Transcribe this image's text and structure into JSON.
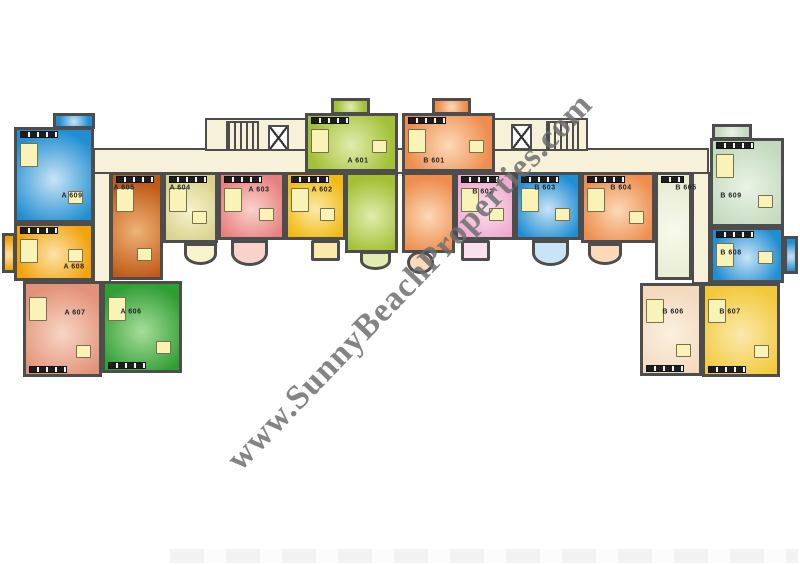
{
  "watermark": {
    "text": "www.SunnyBeachProperties.com",
    "color": "#6f6f6f",
    "rotation_deg": -46
  },
  "floorplan": {
    "wall_color": "#4d4d4d",
    "corridor_color": "#f6f1d8",
    "furniture_fill": "#faf3b8",
    "fixture_color": "#1d1d1d",
    "corridors": [
      {
        "name": "main-hall",
        "x": 93,
        "y": 148,
        "w": 616,
        "h": 26
      },
      {
        "name": "stair-lobby-left",
        "x": 205,
        "y": 118,
        "w": 102,
        "h": 33
      },
      {
        "name": "stair-lobby-right",
        "x": 493,
        "y": 118,
        "w": 95,
        "h": 33
      },
      {
        "name": "left-vertical-hall",
        "x": 93,
        "y": 172,
        "w": 18,
        "h": 145
      },
      {
        "name": "right-vertical-hall",
        "x": 692,
        "y": 172,
        "w": 18,
        "h": 112
      }
    ],
    "stairs": [
      {
        "side": "left",
        "x": 226,
        "y": 121,
        "w": 33,
        "h": 30
      },
      {
        "side": "right",
        "x": 546,
        "y": 121,
        "w": 33,
        "h": 30
      }
    ],
    "elevators": [
      {
        "side": "left",
        "x": 268,
        "y": 125,
        "w": 21,
        "h": 26
      },
      {
        "side": "right",
        "x": 511,
        "y": 124,
        "w": 21,
        "h": 26
      }
    ],
    "units": [
      {
        "id": "A609",
        "label": "A 609",
        "color": "#1f8ed2",
        "light": "#c9e4f5",
        "rects": [
          {
            "x": 14,
            "y": 127,
            "w": 80,
            "h": 96
          },
          {
            "x": 53,
            "y": 113,
            "w": 42,
            "h": 16
          }
        ],
        "label_pos": {
          "x": 72,
          "y": 196
        },
        "fixture": "top"
      },
      {
        "id": "A608",
        "label": "A 608",
        "color": "#f2a30c",
        "light": "#fce3a8",
        "rects": [
          {
            "x": 14,
            "y": 223,
            "w": 80,
            "h": 58
          },
          {
            "x": 2,
            "y": 233,
            "w": 14,
            "h": 40
          }
        ],
        "label_pos": {
          "x": 74,
          "y": 267
        },
        "fixture": "top"
      },
      {
        "id": "A607",
        "label": "A 607",
        "color": "#e39178",
        "light": "#f7d6c5",
        "rects": [
          {
            "x": 23,
            "y": 281,
            "w": 79,
            "h": 96
          }
        ],
        "label_pos": {
          "x": 75,
          "y": 313
        },
        "fixture": "bottom"
      },
      {
        "id": "A606",
        "label": "A 606",
        "color": "#2f9e33",
        "light": "#a8dd9a",
        "rects": [
          {
            "x": 102,
            "y": 281,
            "w": 80,
            "h": 92
          }
        ],
        "label_pos": {
          "x": 131,
          "y": 312
        },
        "fixture": "bottom"
      },
      {
        "id": "A605",
        "label": "A 605",
        "color": "#c05a17",
        "light": "#efb377",
        "rects": [
          {
            "x": 110,
            "y": 172,
            "w": 53,
            "h": 108
          }
        ],
        "label_pos": {
          "x": 124,
          "y": 188
        },
        "fixture": "top"
      },
      {
        "id": "A604",
        "label": "A 604",
        "color": "#d8d28b",
        "light": "#f7f3cd",
        "rects": [
          {
            "x": 163,
            "y": 172,
            "w": 55,
            "h": 71
          }
        ],
        "balcony": {
          "x": 184,
          "y": 243,
          "w": 33,
          "h": 22,
          "shape": "semi"
        },
        "label_pos": {
          "x": 180,
          "y": 188
        },
        "fixture": "top"
      },
      {
        "id": "A603",
        "label": "A 603",
        "color": "#e88080",
        "light": "#f9d3cb",
        "rects": [
          {
            "x": 218,
            "y": 172,
            "w": 67,
            "h": 68
          }
        ],
        "balcony": {
          "x": 231,
          "y": 240,
          "w": 37,
          "h": 26,
          "shape": "semi"
        },
        "label_pos": {
          "x": 259,
          "y": 190
        },
        "fixture": "top"
      },
      {
        "id": "A602",
        "label": "A 602",
        "color": "#f1ba10",
        "light": "#fbe9a8",
        "rects": [
          {
            "x": 285,
            "y": 172,
            "w": 61,
            "h": 68
          }
        ],
        "balcony": {
          "x": 311,
          "y": 240,
          "w": 29,
          "h": 21,
          "shape": "rect"
        },
        "label_pos": {
          "x": 322,
          "y": 190
        },
        "fixture": "top"
      },
      {
        "id": "A601",
        "label": "A 601",
        "color": "#a3c135",
        "light": "#e1ecae",
        "rects": [
          {
            "x": 305,
            "y": 113,
            "w": 93,
            "h": 59
          },
          {
            "x": 345,
            "y": 172,
            "w": 53,
            "h": 81
          },
          {
            "x": 331,
            "y": 98,
            "w": 39,
            "h": 17
          }
        ],
        "balcony": {
          "x": 360,
          "y": 251,
          "w": 31,
          "h": 19,
          "shape": "semi"
        },
        "label_pos": {
          "x": 358,
          "y": 161
        },
        "fixture": "top"
      },
      {
        "id": "B601",
        "label": "B 601",
        "color": "#ee8e4e",
        "light": "#fbd9b9",
        "rects": [
          {
            "x": 402,
            "y": 113,
            "w": 93,
            "h": 59
          },
          {
            "x": 402,
            "y": 172,
            "w": 53,
            "h": 81
          },
          {
            "x": 432,
            "y": 98,
            "w": 39,
            "h": 17
          }
        ],
        "balcony": {
          "x": 407,
          "y": 251,
          "w": 27,
          "h": 23,
          "shape": "circle"
        },
        "label_pos": {
          "x": 434,
          "y": 161
        },
        "fixture": "top"
      },
      {
        "id": "B602",
        "label": "B 602",
        "color": "#eeaacd",
        "light": "#fadfee",
        "rects": [
          {
            "x": 455,
            "y": 172,
            "w": 60,
            "h": 68
          }
        ],
        "balcony": {
          "x": 461,
          "y": 240,
          "w": 29,
          "h": 21,
          "shape": "rect"
        },
        "label_pos": {
          "x": 483,
          "y": 192
        },
        "fixture": "top"
      },
      {
        "id": "B603",
        "label": "B 603",
        "color": "#1f8ed2",
        "light": "#c9e4f5",
        "rects": [
          {
            "x": 515,
            "y": 172,
            "w": 66,
            "h": 68
          }
        ],
        "balcony": {
          "x": 532,
          "y": 240,
          "w": 37,
          "h": 26,
          "shape": "semi"
        },
        "label_pos": {
          "x": 545,
          "y": 188
        },
        "fixture": "top"
      },
      {
        "id": "B604",
        "label": "B 604",
        "color": "#ee8e4e",
        "light": "#fbd9b9",
        "rects": [
          {
            "x": 581,
            "y": 172,
            "w": 74,
            "h": 71
          }
        ],
        "balcony": {
          "x": 588,
          "y": 243,
          "w": 34,
          "h": 22,
          "shape": "semi"
        },
        "label_pos": {
          "x": 621,
          "y": 188
        },
        "fixture": "top"
      },
      {
        "id": "B605",
        "label": "B 605",
        "color": "#e9edd3",
        "light": "#f8f9ec",
        "rects": [
          {
            "x": 655,
            "y": 172,
            "w": 37,
            "h": 108
          }
        ],
        "label_pos": {
          "x": 686,
          "y": 188
        },
        "fixture": "top"
      },
      {
        "id": "B609",
        "label": "B 609",
        "color": "#c4dabe",
        "light": "#eaf3e6",
        "rects": [
          {
            "x": 710,
            "y": 138,
            "w": 74,
            "h": 89
          },
          {
            "x": 712,
            "y": 124,
            "w": 40,
            "h": 16
          }
        ],
        "label_pos": {
          "x": 731,
          "y": 196
        },
        "fixture": "top"
      },
      {
        "id": "B608",
        "label": "B 608",
        "color": "#1f8ed2",
        "light": "#c9e4f5",
        "rects": [
          {
            "x": 710,
            "y": 227,
            "w": 74,
            "h": 56
          },
          {
            "x": 784,
            "y": 236,
            "w": 14,
            "h": 38
          }
        ],
        "label_pos": {
          "x": 731,
          "y": 253
        },
        "fixture": "top"
      },
      {
        "id": "B606",
        "label": "B 606",
        "color": "#f3dabd",
        "light": "#fbf0df",
        "rects": [
          {
            "x": 640,
            "y": 283,
            "w": 62,
            "h": 93
          }
        ],
        "label_pos": {
          "x": 673,
          "y": 312
        },
        "fixture": "bottom"
      },
      {
        "id": "B607",
        "label": "B 607",
        "color": "#f3c93c",
        "light": "#fbe9ad",
        "rects": [
          {
            "x": 702,
            "y": 283,
            "w": 78,
            "h": 94
          }
        ],
        "label_pos": {
          "x": 730,
          "y": 312
        },
        "fixture": "bottom"
      }
    ]
  }
}
